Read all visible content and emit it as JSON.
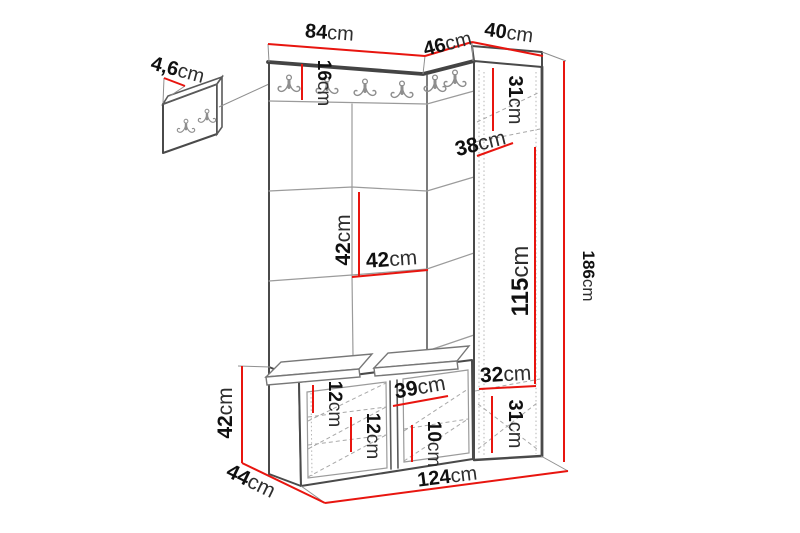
{
  "diagram": {
    "type": "furniture-dimension-diagram",
    "subject": "hallway set: wall hook panel, upholstered panel wall with hook rail, corner wardrobe, storage bench",
    "unit": "cm",
    "colors": {
      "dimension_line": "#e8150f",
      "edge": "#4a4a4a",
      "hidden_line": "#a8a8a8",
      "label_number": "#101010",
      "background": "#ffffff"
    },
    "dims": {
      "d84": {
        "value": "84",
        "unit": "cm"
      },
      "d46": {
        "value": "46",
        "unit": "cm"
      },
      "d40": {
        "value": "40",
        "unit": "cm"
      },
      "d4_6": {
        "value": "4,6",
        "unit": "cm"
      },
      "d16": {
        "value": "16",
        "unit": "cm"
      },
      "d31_top": {
        "value": "31",
        "unit": "cm"
      },
      "d38": {
        "value": "38",
        "unit": "cm"
      },
      "d42_wall_v": {
        "value": "42",
        "unit": "cm"
      },
      "d42_wall_h": {
        "value": "42",
        "unit": "cm"
      },
      "d115": {
        "value": "115",
        "unit": "cm"
      },
      "d186": {
        "value": "186",
        "unit": "cm"
      },
      "d42_bench": {
        "value": "42",
        "unit": "cm"
      },
      "d44": {
        "value": "44",
        "unit": "cm"
      },
      "d12_upper": {
        "value": "12",
        "unit": "cm"
      },
      "d12_lower": {
        "value": "12",
        "unit": "cm"
      },
      "d39": {
        "value": "39",
        "unit": "cm"
      },
      "d10": {
        "value": "10",
        "unit": "cm"
      },
      "d32": {
        "value": "32",
        "unit": "cm"
      },
      "d31_bottom": {
        "value": "31",
        "unit": "cm"
      },
      "d124": {
        "value": "124",
        "unit": "cm"
      }
    }
  }
}
